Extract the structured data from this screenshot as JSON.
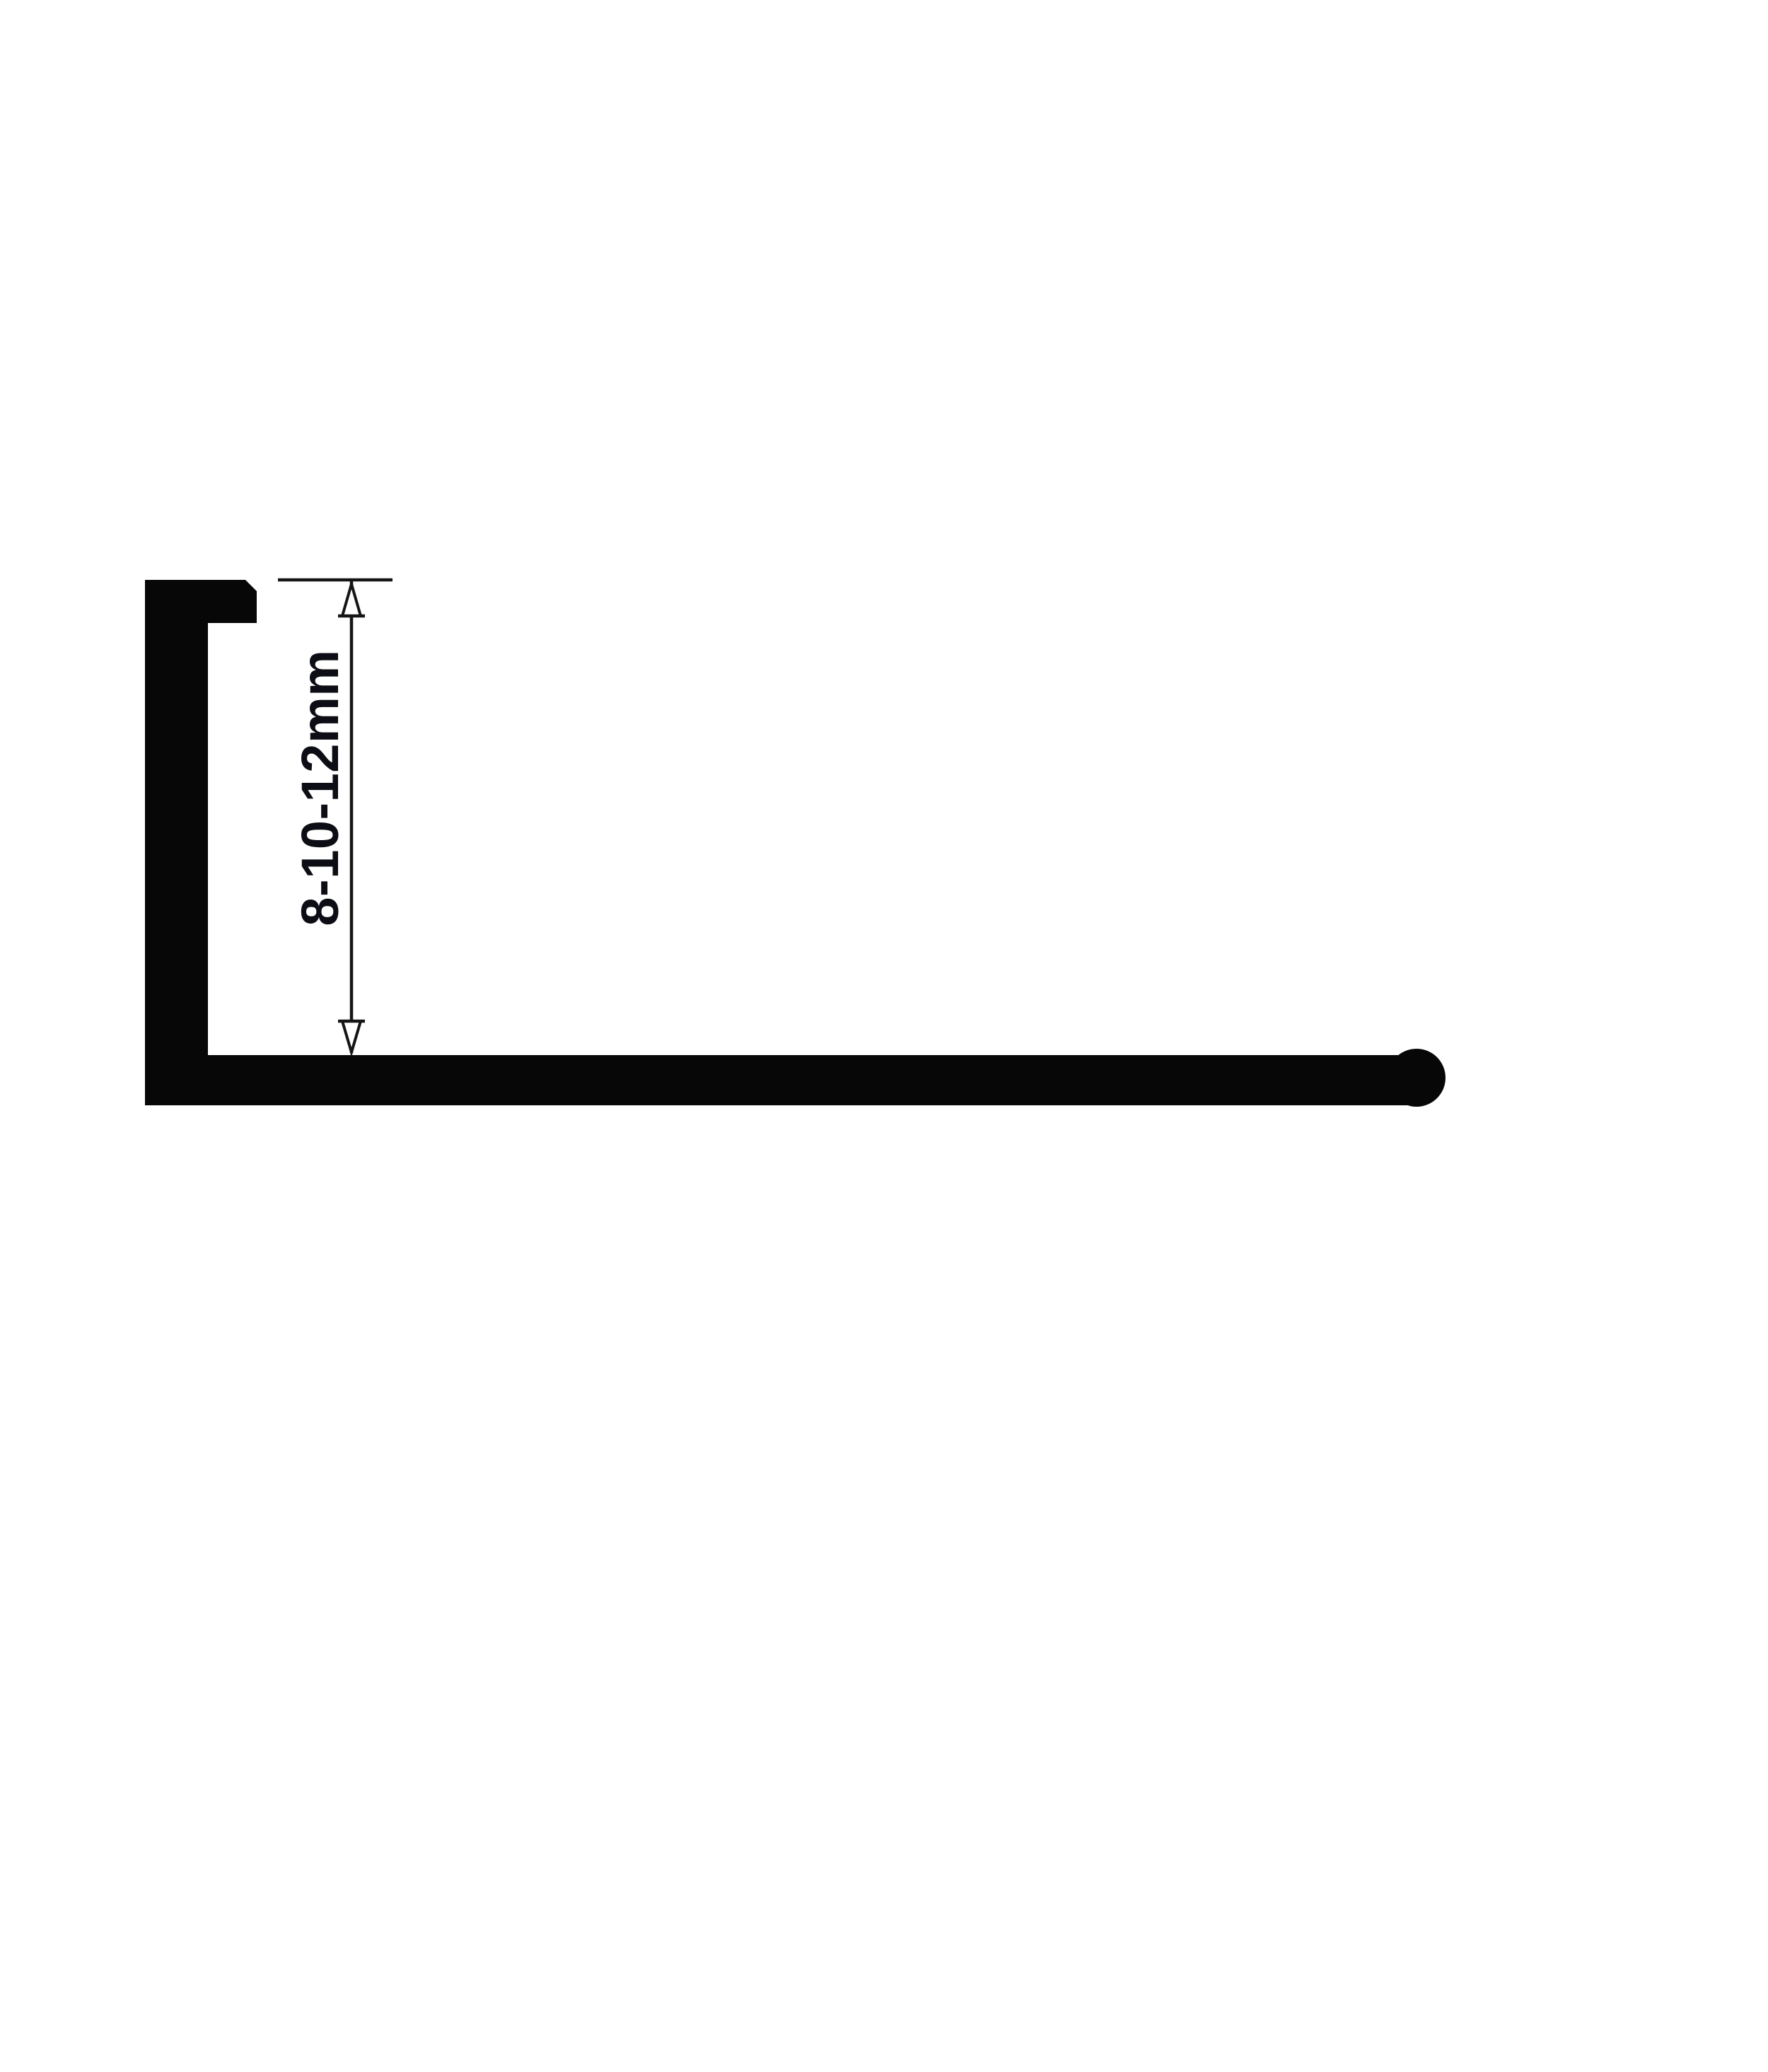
{
  "diagram": {
    "dimension_label": "8-10-12mm",
    "colors": {
      "background": "#ffffff",
      "profile": "#070707",
      "line": "#151515",
      "arrow_fill": "#ffffff",
      "label_text": "#0d0d15"
    }
  }
}
